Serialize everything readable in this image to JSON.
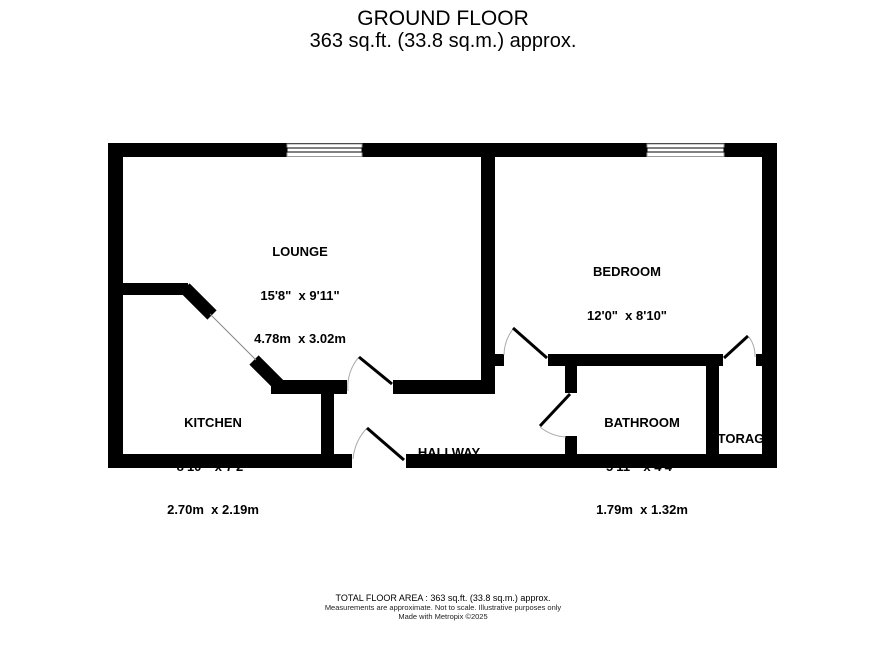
{
  "title": {
    "line1": "GROUND FLOOR",
    "line2": "363 sq.ft. (33.8 sq.m.) approx."
  },
  "rooms": {
    "lounge": {
      "name": "LOUNGE",
      "imperial": "15'8\"  x 9'11\"",
      "metric": "4.78m  x 3.02m"
    },
    "bedroom": {
      "name": "BEDROOM",
      "imperial": "12'0\"  x 8'10\"",
      "metric": "3.65m  x 2.69m"
    },
    "kitchen": {
      "name": "KITCHEN",
      "imperial": "8'10\"  x 7'2\"",
      "metric": "2.70m  x 2.19m"
    },
    "bathroom": {
      "name": "BATHROOM",
      "imperial": "5'11\"  x 4'4\"",
      "metric": "1.79m  x 1.32m"
    },
    "hallway": {
      "name": "HALLWAY"
    },
    "storage": {
      "name": "STORAGE"
    }
  },
  "footer": {
    "line1": "TOTAL FLOOR AREA : 363 sq.ft. (33.8 sq.m.) approx.",
    "line2": "Measurements are approximate.  Not to scale.  Illustrative purposes only",
    "line3": "Made with Metropix ©2025"
  },
  "colors": {
    "wall": "#000000",
    "background": "#ffffff",
    "door_arc": "#aaaaaa",
    "window_frame": "#999999"
  }
}
